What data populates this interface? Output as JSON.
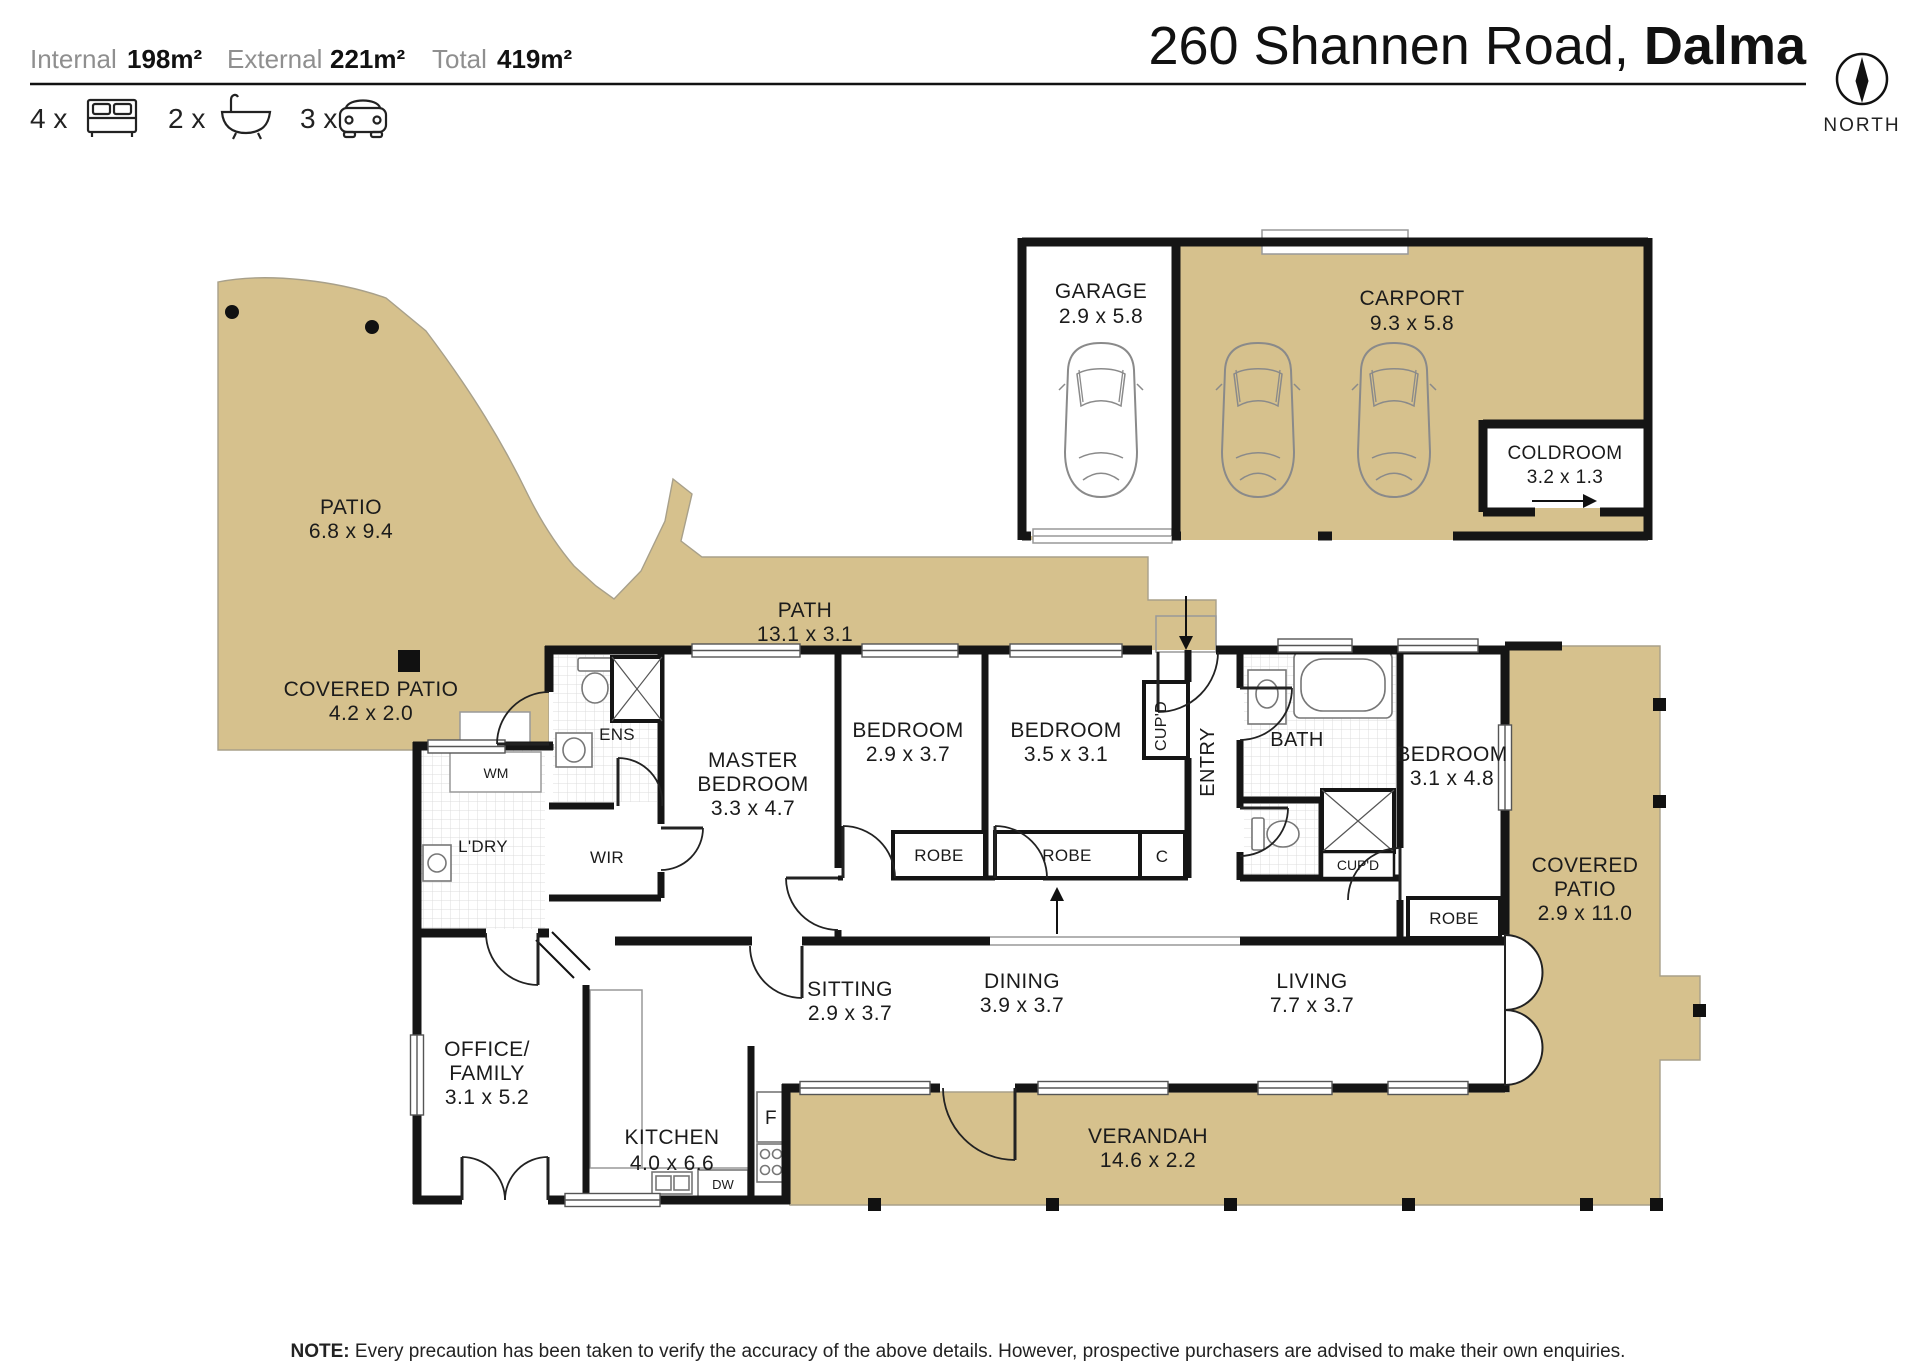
{
  "header": {
    "areas": [
      {
        "label": "Internal",
        "value": "198m²"
      },
      {
        "label": "External",
        "value": "221m²"
      },
      {
        "label": "Total",
        "value": "419m²"
      }
    ],
    "features": [
      {
        "count": "4 x",
        "icon": "bed-icon"
      },
      {
        "count": "2 x",
        "icon": "bath-icon"
      },
      {
        "count": "3 x",
        "icon": "car-icon"
      }
    ],
    "address": {
      "street": "260 Shannen Road, ",
      "suburb": "Dalma"
    },
    "compass_label": "NORTH"
  },
  "rooms": {
    "patio": {
      "name": "PATIO",
      "dims": "6.8 x 9.4"
    },
    "path": {
      "name": "PATH",
      "dims": "13.1 x 3.1"
    },
    "garage": {
      "name": "GARAGE",
      "dims": "2.9 x 5.8"
    },
    "carport": {
      "name": "CARPORT",
      "dims": "9.3 x 5.8"
    },
    "coldroom": {
      "name": "COLDROOM",
      "dims": "3.2 x 1.3"
    },
    "covered_patio_left": {
      "name": "COVERED PATIO",
      "dims": "4.2 x 2.0"
    },
    "covered_patio_right": {
      "line1": "COVERED",
      "line2": "PATIO",
      "dims": "2.9 x 11.0"
    },
    "verandah": {
      "name": "VERANDAH",
      "dims": "14.6 x 2.2"
    },
    "master_bedroom": {
      "line1": "MASTER",
      "line2": "BEDROOM",
      "dims": "3.3 x 4.7"
    },
    "bedroom2": {
      "name": "BEDROOM",
      "dims": "2.9 x 3.7"
    },
    "bedroom3": {
      "name": "BEDROOM",
      "dims": "3.5 x 3.1"
    },
    "bedroom4": {
      "name": "BEDROOM",
      "dims": "3.1 x 4.8"
    },
    "sitting": {
      "name": "SITTING",
      "dims": "2.9 x 3.7"
    },
    "dining": {
      "name": "DINING",
      "dims": "3.9 x 3.7"
    },
    "living": {
      "name": "LIVING",
      "dims": "7.7 x 3.7"
    },
    "office_family": {
      "line1": "OFFICE/",
      "line2": "FAMILY",
      "dims": "3.1 x 5.2"
    },
    "kitchen": {
      "name": "KITCHEN",
      "dims": "4.0 x 6.6"
    },
    "ens": {
      "name": "ENS"
    },
    "wir": {
      "name": "WIR"
    },
    "ldry": {
      "name": "L'DRY"
    },
    "wm": {
      "name": "WM"
    },
    "bath": {
      "name": "BATH"
    },
    "entry": {
      "name": "ENTRY"
    },
    "cupd_hall": {
      "name": "CUP'D"
    },
    "cupd_bath": {
      "name": "CUP'D"
    },
    "c_cupboard": {
      "name": "C"
    },
    "robe_bed2": {
      "name": "ROBE"
    },
    "robe_bed3": {
      "name": "ROBE"
    },
    "robe_bed4": {
      "name": "ROBE"
    },
    "fridge": {
      "name": "F"
    },
    "dishwasher": {
      "name": "DW"
    }
  },
  "note": {
    "prefix": "NOTE:",
    "text": " Every precaution has been taken to verify the accuracy of the above details. However, prospective purchasers are advised to make their own enquiries."
  },
  "colors": {
    "floor_external": "#d6c18d",
    "wall": "#151515"
  }
}
